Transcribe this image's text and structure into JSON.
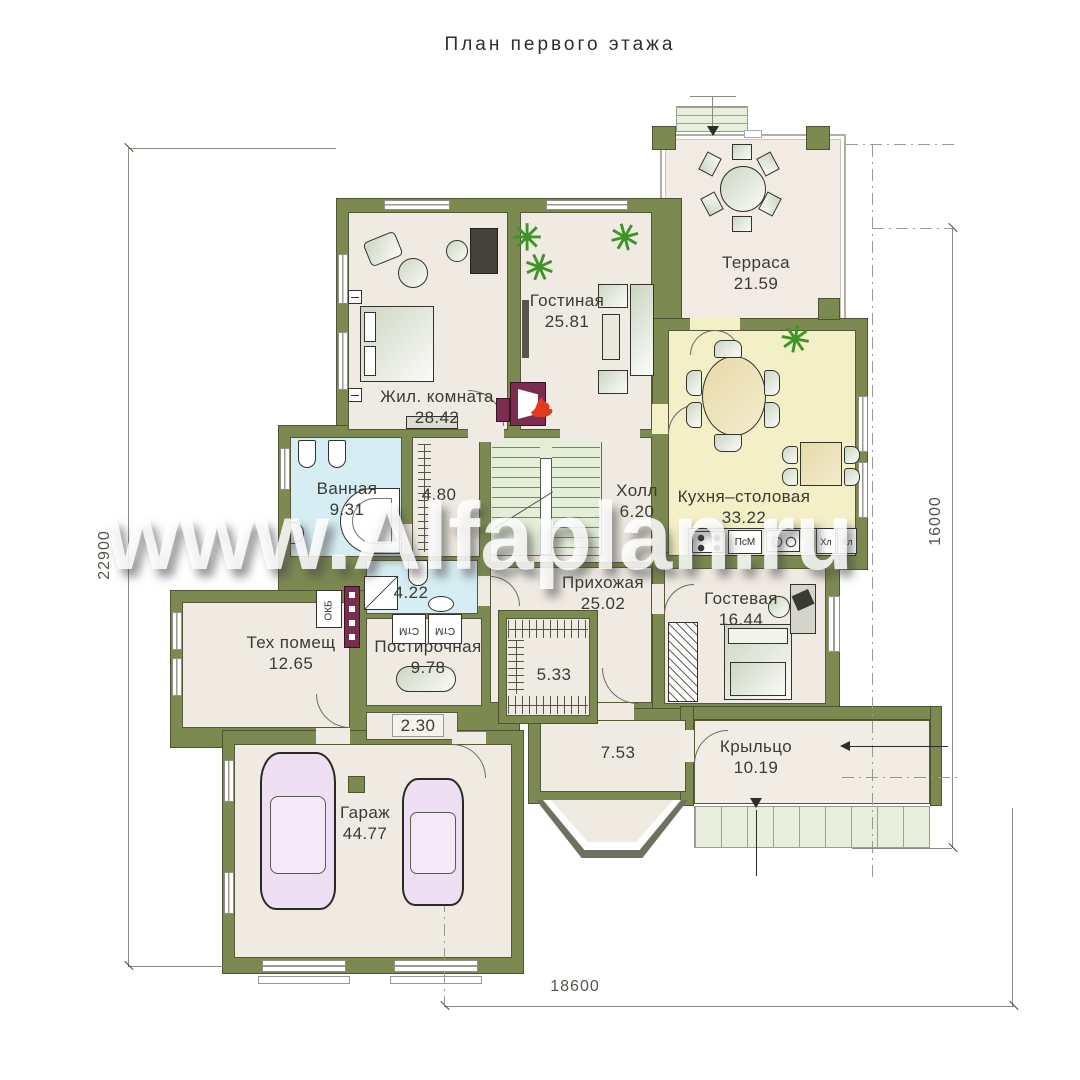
{
  "title": "План первого этажа",
  "watermark": "www.Alfaplan.ru",
  "dimensions": {
    "left": "22900",
    "right": "16000",
    "bottom": "18600"
  },
  "rooms": {
    "bedroom": {
      "name": "Жил. комната",
      "area": "28.42"
    },
    "living": {
      "name": "Гостиная",
      "area": "25.81"
    },
    "terrace": {
      "name": "Терраса",
      "area": "21.59"
    },
    "kitchen": {
      "name": "Кухня–столовая",
      "area": "33.22"
    },
    "bathroom": {
      "name": "Ванная",
      "area": "9.31"
    },
    "closet480": {
      "area": "4.80"
    },
    "hall": {
      "name": "Холл",
      "area": "6.20"
    },
    "shower422": {
      "area": "4.22"
    },
    "entryhall": {
      "name": "Прихожая",
      "area": "25.02"
    },
    "guest": {
      "name": "Гостевая",
      "area": "16.44"
    },
    "tech": {
      "name": "Тех помещ",
      "area": "12.65"
    },
    "laundry": {
      "name": "Постирочная",
      "area": "9.78"
    },
    "closet533": {
      "area": "5.33"
    },
    "niche230": {
      "area": "2.30"
    },
    "tambour753": {
      "area": "7.53"
    },
    "porch": {
      "name": "Крыльцо",
      "area": "10.19"
    },
    "garage": {
      "name": "Гараж",
      "area": "44.77"
    }
  },
  "appliances": {
    "dishwasher": "ПсМ",
    "fridge": "Хл",
    "washer": "СтМ",
    "boiler": "ОКБ"
  },
  "icons": {
    "plant": "✳"
  },
  "colors": {
    "wall": "#7c8a51",
    "floor": "#f0ebe2",
    "kitchen_floor": "#f3efc6",
    "wet_floor": "#d6edf3",
    "stairs": "#e4eed8",
    "car": "#eedff2",
    "fireplace": "#7b2d50",
    "plant": "#3f9427"
  }
}
